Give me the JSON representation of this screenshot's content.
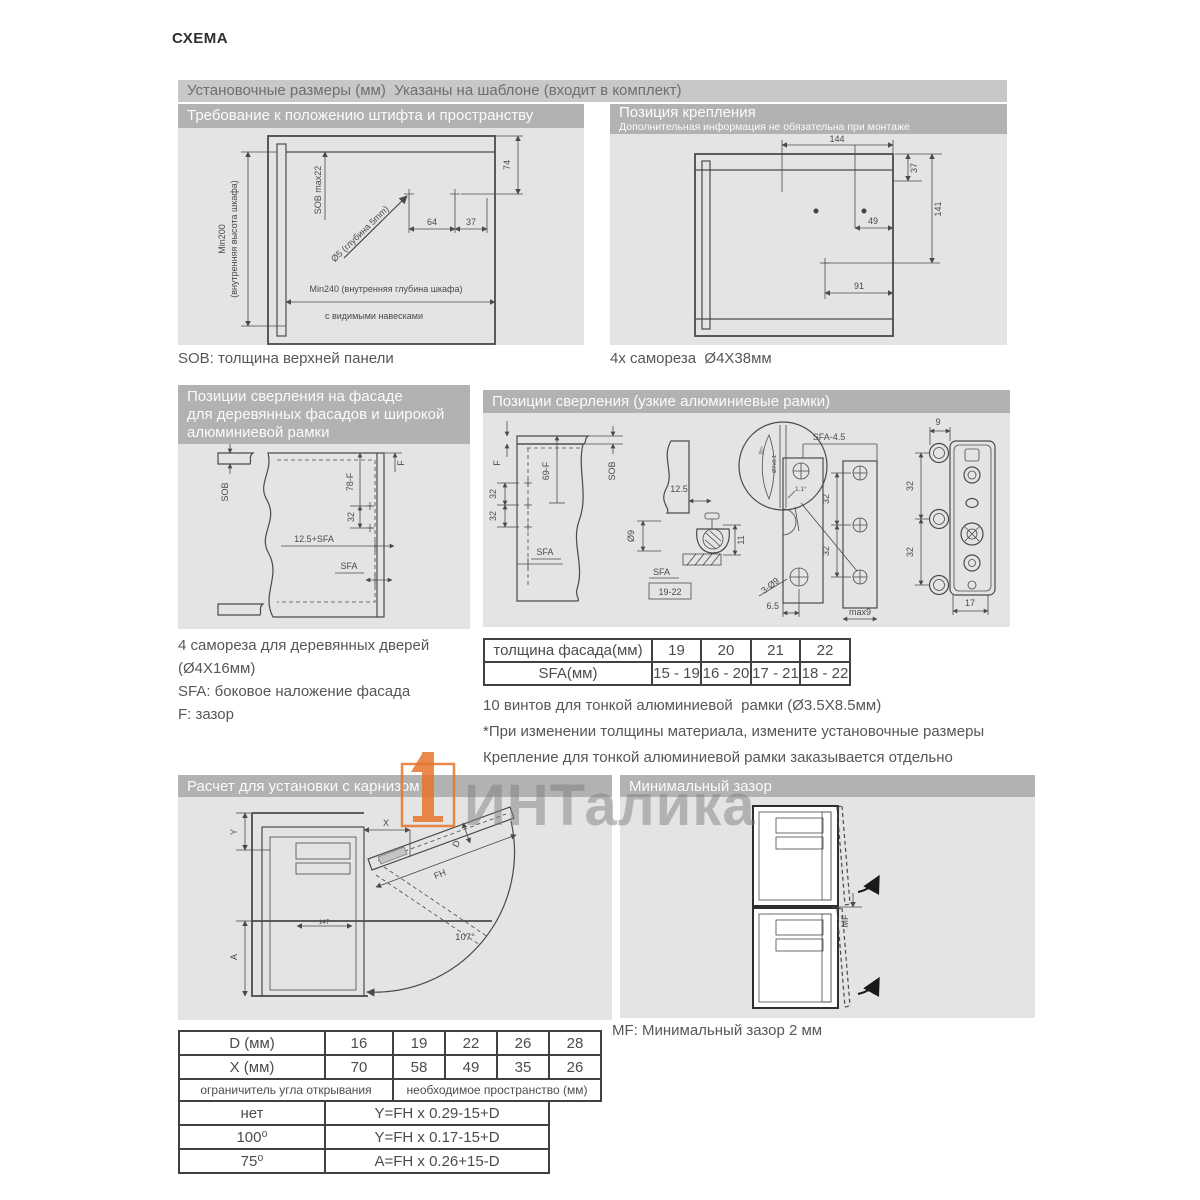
{
  "page": {
    "title": "СХЕМА"
  },
  "banner": {
    "text": "Установочные размеры (мм)  Указаны на шаблоне (входит в комплект)"
  },
  "sec_pin": {
    "header": "Требование к положению штифта и пространству",
    "caption": "SOB: толщина верхней панели",
    "dims": {
      "min200a": "Min200",
      "min200b": "(внутренняя высота шкафа)",
      "sob": "SOB max22",
      "dia5": "Ø5 (глубина 5mm)",
      "d64": "64",
      "d37": "37",
      "d74": "74",
      "min240": "Min240 (внутренняя глубина шкафа)",
      "hinges": "с видимыми навесками"
    }
  },
  "sec_mount": {
    "header": "Позиция крепления",
    "subheader": "Дополнительная информация не обязательна при монтаже",
    "caption": "4x самореза  Ø4X38мм",
    "dims": {
      "d144": "144",
      "d37": "37",
      "d141": "141",
      "d49": "49",
      "d91": "91"
    }
  },
  "sec_wood": {
    "header1": "Позиции сверления на фасаде",
    "header2": "для деревянных фасадов и широкой",
    "header3": "алюминиевой рамки",
    "captions": [
      "4 самореза для деревянных дверей",
      "(Ø4X16мм)",
      "SFA: боковое наложение фасада",
      "F: зазор"
    ],
    "dims": {
      "sob": "SOB",
      "f78": "78-F",
      "f": "F",
      "d32": "32",
      "sfa12": "12.5+SFA",
      "sfa": "SFA"
    }
  },
  "sec_alu": {
    "header": "Позиции сверления (узкие алюминиевые рамки)",
    "dims": {
      "f": "F",
      "f69": "69-F",
      "sob": "SOB",
      "d32a": "32",
      "d32b": "32",
      "sfa_a": "SFA",
      "d125": "12.5",
      "dia9": "Ø9",
      "d11": "11",
      "sfa_b": "SFA",
      "r1922": "19-22",
      "deg90": "90°",
      "dia7": "Ø7±0.1",
      "d11s": "1.1°",
      "sfa45": "SFA-4.5",
      "d3d9": "3-Ø9",
      "d65": "6.5",
      "d32c": "32",
      "d32d": "32",
      "max9": "max9",
      "d9": "9",
      "d32e": "32",
      "d32f": "32",
      "d17": "17"
    },
    "table": {
      "r1": [
        "толщина фасада(мм)",
        "19",
        "20",
        "21",
        "22"
      ],
      "r2": [
        "SFA(мм)",
        "15 - 19",
        "16 - 20",
        "17 - 21",
        "18 - 22"
      ]
    },
    "notes": [
      "10 винтов для тонкой алюминиевой  рамки (Ø3.5X8.5мм)",
      "*При изменении толщины материала, измените установочные размеры",
      "Крепление для тонкой алюминиевой рамки заказывается отдельно"
    ]
  },
  "sec_cornice": {
    "header": "Расчет для установки с карнизом",
    "dims": {
      "y": "Y",
      "x": "X",
      "d": "D",
      "fh": "FH",
      "a": "A",
      "d147": "147",
      "deg107": "107°"
    }
  },
  "sec_gap": {
    "header": "Минимальный зазор",
    "caption": "MF: Минимальный зазор 2 мм",
    "dims": {
      "mf": "MF"
    }
  },
  "calc_table": {
    "d_row": [
      "D (мм)",
      "16",
      "19",
      "22",
      "26",
      "28"
    ],
    "x_row": [
      "X (мм)",
      "70",
      "58",
      "49",
      "35",
      "26"
    ],
    "hdr": [
      "ограничитель угла открывания",
      "необходимое пространство (мм)"
    ],
    "rows": [
      [
        "нет",
        "Y=FH x 0.29-15+D"
      ],
      [
        "100⁰",
        "Y=FH x 0.17-15+D"
      ],
      [
        "75⁰",
        "A=FH x 0.26+15-D"
      ]
    ]
  },
  "watermark": {
    "text": "ИНТалика",
    "logo_color": "#e8742c"
  }
}
